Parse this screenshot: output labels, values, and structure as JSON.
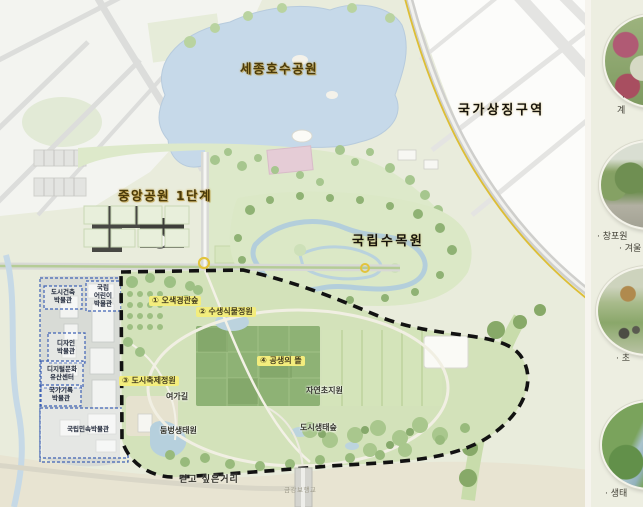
{
  "map": {
    "major_labels": {
      "lake_park": "세종호수공원",
      "national_symbol_zone": "국가상징구역",
      "central_park_phase1": "중앙공원 1단계",
      "national_arboretum": "국립수목원"
    },
    "zones": [
      {
        "label": "① 오색경관숲"
      },
      {
        "label": "② 수생식물정원"
      },
      {
        "label": "③ 도시축제정원"
      },
      {
        "label": "④ 공생의 뜰"
      }
    ],
    "features": {
      "leisure_trail": "여가길",
      "natural_grassland": "자연초지원",
      "pond_ecology_garden": "둠벙생태원",
      "urban_ecology_forest": "도시생태숲",
      "walking_street": "걷고 싶은거리",
      "geumgang_footbridge": "금강보행교"
    },
    "museums": [
      {
        "line1": "도시건축",
        "line2": "박물관",
        "line3": ""
      },
      {
        "line1": "국립",
        "line2": "어린이",
        "line3": "박물관"
      },
      {
        "line1": "디자인",
        "line2": "박물관",
        "line3": ""
      },
      {
        "line1": "디지털문화",
        "line2": "유산센터",
        "line3": ""
      },
      {
        "line1": "국가기록",
        "line2": "박물관",
        "line3": ""
      },
      {
        "line1": "국립민속박물관",
        "line2": "",
        "line3": ""
      }
    ],
    "colors": {
      "zone_highlight": "#f3ed7d",
      "phase2_boundary": "#121212",
      "museum_box_border": "#3f62b5",
      "water": "#c6d9e9",
      "park_green": "#d3e2ba",
      "sidebar_background": "#edeee1"
    }
  },
  "sidebar": {
    "photos": [
      {
        "name": "flower-garden-photo",
        "caption_line1": "·",
        "caption_line2": "계"
      },
      {
        "name": "arboretum-trees-photo",
        "caption_line1": "· 창포원",
        "caption_line2": "· 겨울"
      },
      {
        "name": "festival-garden-photo",
        "caption_line1": "· 초",
        "caption_line2": ""
      },
      {
        "name": "river-ecology-photo",
        "caption_line1": "· 생태",
        "caption_line2": ""
      }
    ]
  }
}
